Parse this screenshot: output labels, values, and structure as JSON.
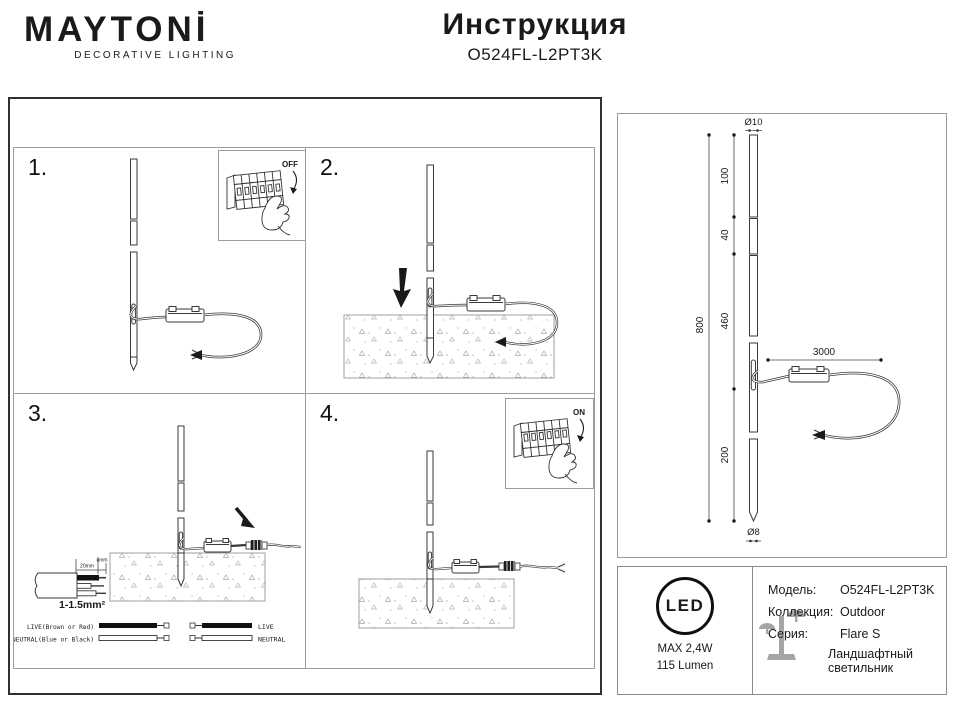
{
  "header": {
    "brand": "MAYTONİ",
    "tagline": "DECORATIVE LIGHTING",
    "title": "Инструкция",
    "model": "O524FL-L2PT3K"
  },
  "steps": [
    {
      "number": "1.",
      "breaker_label": "OFF"
    },
    {
      "number": "2."
    },
    {
      "number": "3.",
      "cable": {
        "strip_len": "20mm",
        "bare_len": "8mm",
        "cross_section": "1-1.5mm²",
        "live_label": "LIVE(Brown or Red)",
        "neutral_label": "NEUTRAL(Blue or Black)",
        "live_short": "LIVE",
        "neutral_short": "NEUTRAL"
      }
    },
    {
      "number": "4.",
      "breaker_label": "ON"
    }
  ],
  "dimensions": {
    "top_diameter": "Ø10",
    "segment_100": "100",
    "segment_40": "40",
    "segment_460": "460",
    "overall": "800",
    "segment_200": "200",
    "cable_length": "3000",
    "bottom_diameter": "Ø8"
  },
  "product": {
    "led_badge": "LED",
    "max_power": "MAX 2,4W",
    "luminous_flux": "115 Lumen",
    "model_label": "Модель:",
    "model_value": "O524FL-L2PT3K",
    "collection_label": "Коллекция:",
    "collection_value": "Outdoor",
    "series_label": "Серия:",
    "series_value": "Flare S",
    "series_note": "Ландшафтный светильник"
  }
}
